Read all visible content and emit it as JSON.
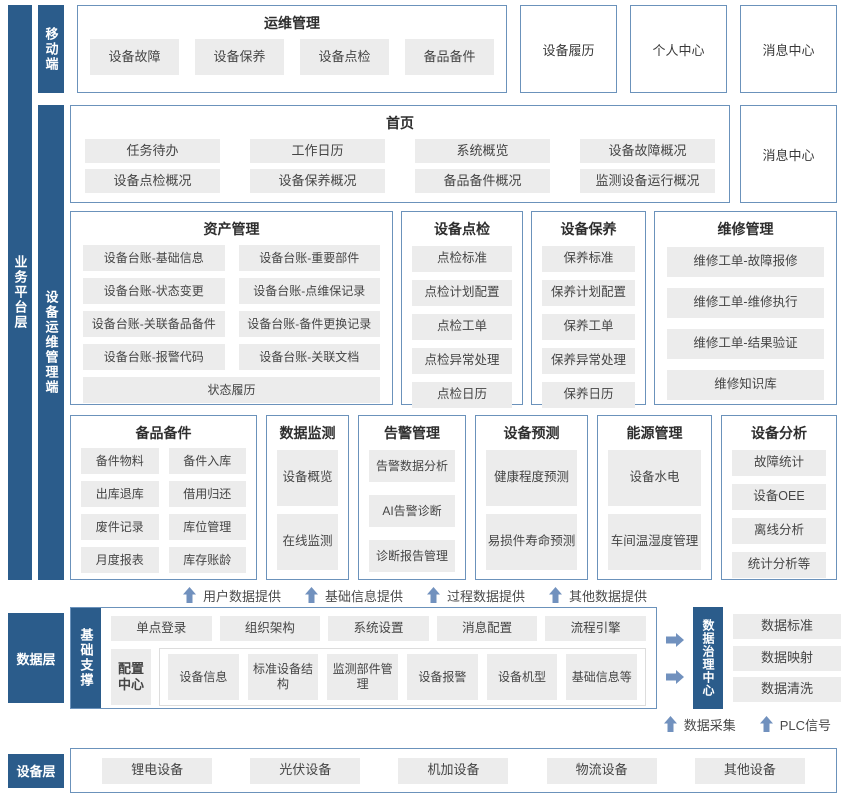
{
  "layers": {
    "business_platform": "业务平台层",
    "mobile": "移动端",
    "device_ops_client": "设备运维管理端",
    "data_layer": "数据层",
    "base_support": "基础支撑",
    "device_layer": "设备层"
  },
  "mobile_row": {
    "ops": {
      "title": "运维管理",
      "items": [
        "设备故障",
        "设备保养",
        "设备点检",
        "备品备件"
      ]
    },
    "device_history": "设备履历",
    "personal_center": "个人中心",
    "message_center": "消息中心"
  },
  "home": {
    "title": "首页",
    "items": [
      "任务待办",
      "工作日历",
      "系统概览",
      "设备故障概况",
      "设备点检概况",
      "设备保养概况",
      "备品备件概况",
      "监测设备运行概况"
    ],
    "message_center": "消息中心"
  },
  "sections": {
    "asset": {
      "title": "资产管理",
      "items": [
        "设备台账-基础信息",
        "设备台账-重要部件",
        "设备台账-状态变更",
        "设备台账-点维保记录",
        "设备台账-关联备品备件",
        "设备台账-备件更换记录",
        "设备台账-报警代码",
        "设备台账-关联文档"
      ],
      "full_item": "状态履历"
    },
    "inspection": {
      "title": "设备点检",
      "items": [
        "点检标准",
        "点检计划配置",
        "点检工单",
        "点检异常处理",
        "点检日历"
      ]
    },
    "maintenance": {
      "title": "设备保养",
      "items": [
        "保养标准",
        "保养计划配置",
        "保养工单",
        "保养异常处理",
        "保养日历"
      ]
    },
    "repair": {
      "title": "维修管理",
      "items": [
        "维修工单-故障报修",
        "维修工单-维修执行",
        "维修工单-结果验证",
        "维修知识库"
      ]
    },
    "spare_parts": {
      "title": "备品备件",
      "items": [
        "备件物料",
        "备件入库",
        "出库退库",
        "借用归还",
        "废件记录",
        "库位管理",
        "月度报表",
        "库存账龄"
      ]
    },
    "data_monitoring": {
      "title": "数据监测",
      "items": [
        "设备概览",
        "在线监测"
      ]
    },
    "alarm": {
      "title": "告警管理",
      "items": [
        "告警数据分析",
        "AI告警诊断",
        "诊断报告管理"
      ]
    },
    "prediction": {
      "title": "设备预测",
      "items": [
        "健康程度预测",
        "易损件寿命预测"
      ]
    },
    "energy": {
      "title": "能源管理",
      "items": [
        "设备水电",
        "车间温湿度管理"
      ]
    },
    "analysis": {
      "title": "设备分析",
      "items": [
        "故障统计",
        "设备OEE",
        "离线分析",
        "统计分析等"
      ]
    }
  },
  "data_flows_up": [
    "用户数据提供",
    "基础信息提供",
    "过程数据提供",
    "其他数据提供"
  ],
  "base_support_box": {
    "row1": [
      "单点登录",
      "组织架构",
      "系统设置",
      "消息配置",
      "流程引擎"
    ],
    "config_center": "配置中心",
    "row2": [
      "设备信息",
      "标准设备结构",
      "监测部件管理",
      "设备报警",
      "设备机型",
      "基础信息等"
    ]
  },
  "governance": {
    "label": "数据治理中心",
    "items": [
      "数据标准",
      "数据映射",
      "数据清洗"
    ],
    "inputs": [
      "数据采集",
      "PLC信号"
    ]
  },
  "devices": [
    "锂电设备",
    "光伏设备",
    "机加设备",
    "物流设备",
    "其他设备"
  ],
  "colors": {
    "accent_dark_blue": "#2B5C8B",
    "box_border_blue": "#6B92BB",
    "chip_background": "#ECECEC",
    "arrow_blue": "#7191BE"
  }
}
